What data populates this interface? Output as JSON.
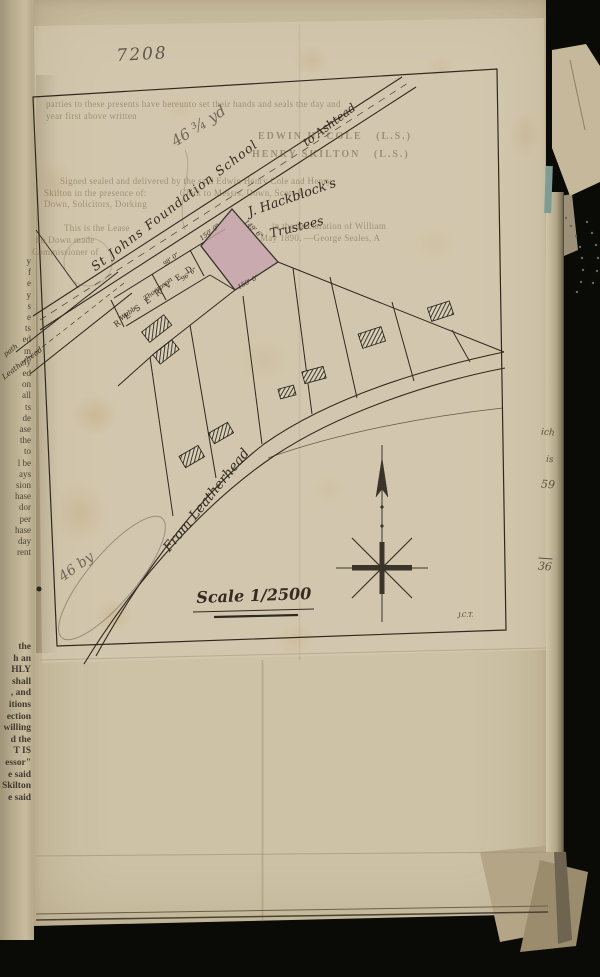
{
  "document": {
    "kind": "Scanned ledger page with pasted surveyor's plan"
  },
  "map": {
    "roads": {
      "main_road_label": "St Johns Foundation School",
      "main_road_destination": "to Ashtead",
      "bottom_road_label": "From Leatherhead",
      "left_road_label_line1": "path",
      "left_road_label_line2": "Leatherhead"
    },
    "parcels": {
      "owner_label_line1": "J. Hackblock's",
      "owner_label_line2": "Trustees",
      "reserved_strip": "RESERVED",
      "plot_webb": "Webb",
      "plot_thompson": "Thompson"
    },
    "dimensions": {
      "webb_frontage": "98' 0\"",
      "thompson_frontage": "96' 6\"",
      "pink_plot_nw": "150' 0\"",
      "pink_plot_se": "150' 0\"",
      "pink_plot_ne": "149' 6\""
    },
    "scale_label": "Scale 1/2500",
    "surveyor_initials": "J.C.T.",
    "colors": {
      "pink_plot": "#c6a2af",
      "ink": "#30291f",
      "map_paper": "#dacfb7"
    }
  },
  "ghost_text": {
    "g1": "parties to these presents have hereunto set their hands and seals the day and",
    "g2": "year first above written",
    "g3": "EDWIN H. COLE   (L.S.)",
    "g4": "HENRY SKILTON   (L.S.)",
    "g5": "Signed sealed and delivered by the said Edwin Henry Cole and Henry",
    "g6": "Skilton in the presence of:             Clerk to Messrs. Down, Scott &",
    "g7": "Down, Solicitors, Dorking",
    "g8a": "This is the Lease",
    "g8b": "in the Declaration of William",
    "g9a": "hn Down made",
    "g9b": "May 1890. —George Seales, A",
    "g10": "Commissioner of"
  },
  "annotations": {
    "top_number": "7208",
    "pencil_note_upper": "46 ¾ yd",
    "pencil_note_lower": "46 by",
    "margin_note_1": "ich",
    "margin_note_2": "is",
    "margin_note_3": "59",
    "margin_note_4": "36"
  },
  "left_page_fragments": {
    "upper": [
      "y",
      "f",
      "e",
      "y",
      "s",
      "e",
      "ts",
      "ed",
      "m",
      "ly",
      "ed",
      "on",
      "all",
      "ts",
      "de",
      "ase",
      "the",
      "to",
      "l be",
      "ays",
      "sion",
      "hase",
      "dor",
      "per",
      "hase",
      "day",
      "rent"
    ],
    "lower": [
      "the",
      "h an",
      "HLY",
      "shall",
      ", and",
      "itions",
      "ection",
      "willing",
      "d the",
      "T IS",
      "essor\"",
      "e said",
      "Skilton",
      "e said"
    ]
  }
}
